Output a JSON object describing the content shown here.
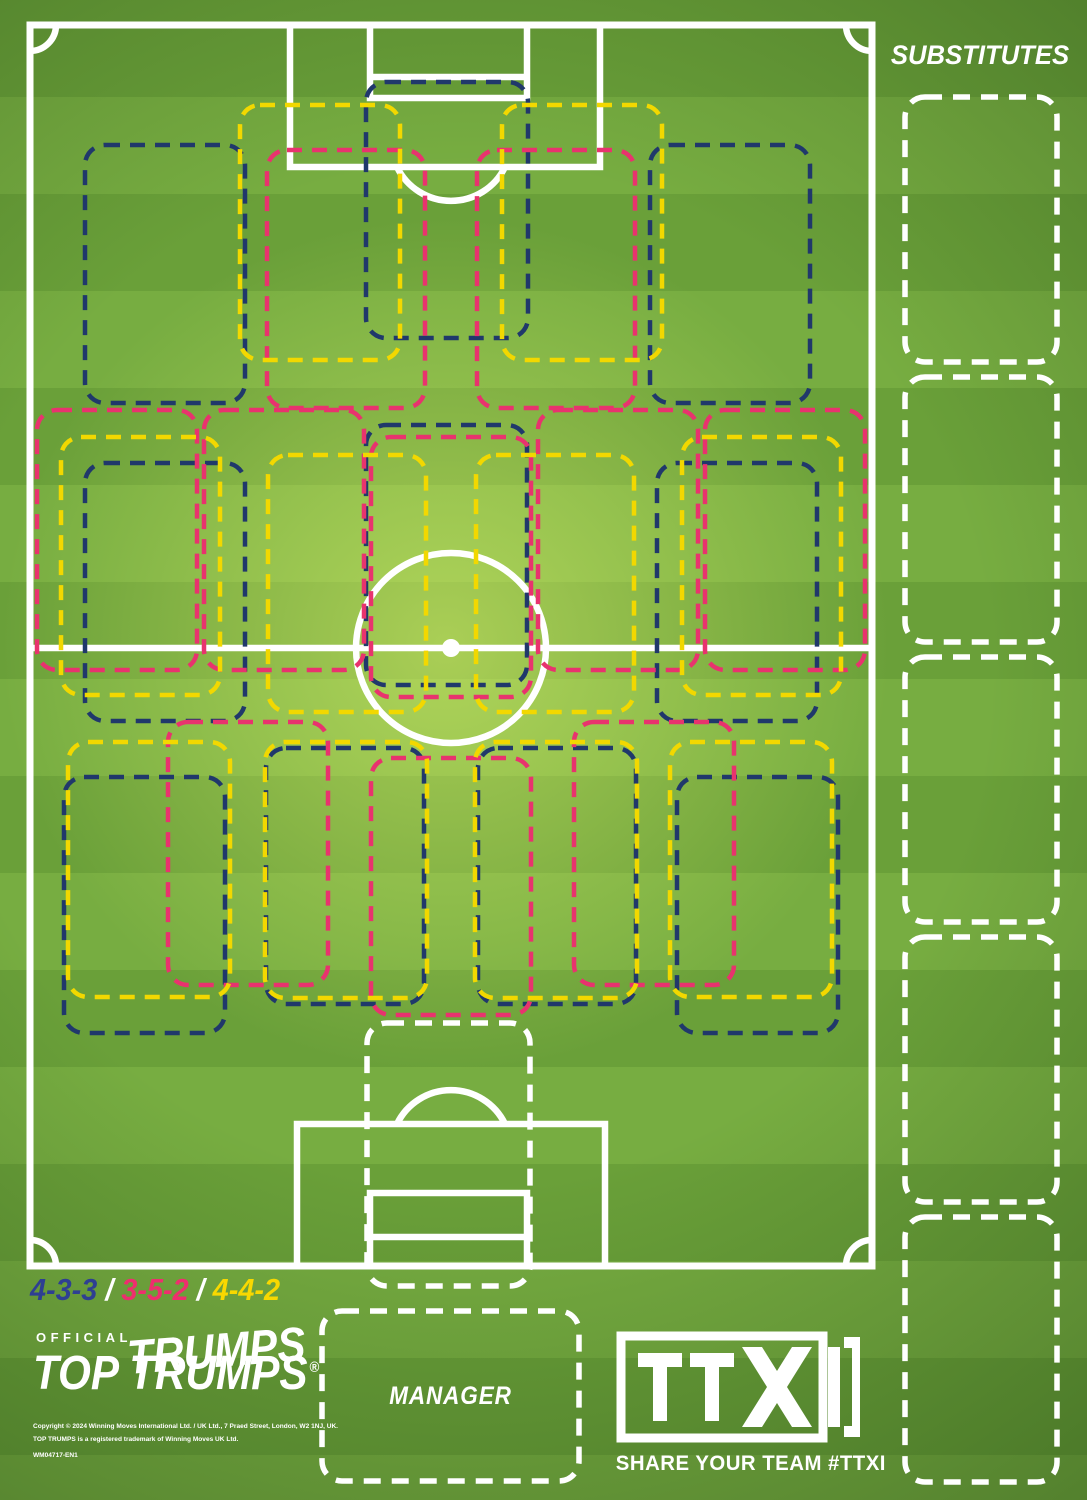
{
  "colors": {
    "field_dark": "#6aa039",
    "field_light": "#77ad41",
    "line_white": "#ffffff",
    "navy": "#20386b",
    "pink": "#e8336e",
    "yellow": "#f2d800"
  },
  "legend": {
    "separator": "/",
    "items": [
      {
        "label": "4-3-3",
        "color": "#2e3f92"
      },
      {
        "label": "3-5-2",
        "color": "#ee2e6e"
      },
      {
        "label": "4-4-2",
        "color": "#f8d800"
      }
    ]
  },
  "formations": [
    {
      "name": "4-3-3",
      "color": "#20386b",
      "slots": [
        {
          "pos": "st",
          "x": 366,
          "y": 82,
          "w": 162,
          "h": 256
        },
        {
          "pos": "lw",
          "x": 85,
          "y": 145,
          "w": 160,
          "h": 258
        },
        {
          "pos": "rw",
          "x": 650,
          "y": 145,
          "w": 160,
          "h": 258
        },
        {
          "pos": "lcm",
          "x": 85,
          "y": 463,
          "w": 160,
          "h": 258
        },
        {
          "pos": "cm",
          "x": 366,
          "y": 425,
          "w": 161,
          "h": 260
        },
        {
          "pos": "rcm",
          "x": 657,
          "y": 463,
          "w": 160,
          "h": 258
        },
        {
          "pos": "lb",
          "x": 64,
          "y": 777,
          "w": 161,
          "h": 256
        },
        {
          "pos": "lcb",
          "x": 266,
          "y": 748,
          "w": 158,
          "h": 256
        },
        {
          "pos": "rcb",
          "x": 478,
          "y": 748,
          "w": 158,
          "h": 256
        },
        {
          "pos": "rb",
          "x": 677,
          "y": 777,
          "w": 161,
          "h": 256
        }
      ]
    },
    {
      "name": "3-5-2",
      "color": "#e8336e",
      "slots": [
        {
          "pos": "st-left",
          "x": 267,
          "y": 150,
          "w": 158,
          "h": 258
        },
        {
          "pos": "st-right",
          "x": 477,
          "y": 150,
          "w": 158,
          "h": 258
        },
        {
          "pos": "lm",
          "x": 37,
          "y": 410,
          "w": 160,
          "h": 260
        },
        {
          "pos": "lcm",
          "x": 204,
          "y": 410,
          "w": 160,
          "h": 260
        },
        {
          "pos": "cm",
          "x": 371,
          "y": 437,
          "w": 160,
          "h": 260
        },
        {
          "pos": "rcm",
          "x": 538,
          "y": 410,
          "w": 160,
          "h": 260
        },
        {
          "pos": "rm",
          "x": 705,
          "y": 410,
          "w": 160,
          "h": 260
        },
        {
          "pos": "cb-left",
          "x": 168,
          "y": 722,
          "w": 160,
          "h": 263
        },
        {
          "pos": "cb-center",
          "x": 371,
          "y": 758,
          "w": 160,
          "h": 257
        },
        {
          "pos": "cb-right",
          "x": 574,
          "y": 722,
          "w": 160,
          "h": 263
        }
      ]
    },
    {
      "name": "4-4-2",
      "color": "#f2d800",
      "slots": [
        {
          "pos": "st-left",
          "x": 240,
          "y": 105,
          "w": 160,
          "h": 255
        },
        {
          "pos": "st-right",
          "x": 502,
          "y": 105,
          "w": 160,
          "h": 255
        },
        {
          "pos": "lm",
          "x": 61,
          "y": 437,
          "w": 159,
          "h": 258
        },
        {
          "pos": "lcm",
          "x": 268,
          "y": 455,
          "w": 158,
          "h": 257
        },
        {
          "pos": "rcm",
          "x": 476,
          "y": 455,
          "w": 158,
          "h": 257
        },
        {
          "pos": "rm",
          "x": 682,
          "y": 437,
          "w": 159,
          "h": 258
        },
        {
          "pos": "lb",
          "x": 68,
          "y": 742,
          "w": 162,
          "h": 255
        },
        {
          "pos": "lcb",
          "x": 265,
          "y": 742,
          "w": 162,
          "h": 256
        },
        {
          "pos": "rcb",
          "x": 475,
          "y": 742,
          "w": 162,
          "h": 256
        },
        {
          "pos": "rb",
          "x": 670,
          "y": 742,
          "w": 162,
          "h": 255
        }
      ]
    }
  ],
  "goalkeeper_slot": {
    "color": "#ffffff",
    "x": 367,
    "y": 1023,
    "w": 163,
    "h": 263
  },
  "substitutes": {
    "title": "SUBSTITUTES",
    "color": "#ffffff",
    "slots": [
      {
        "x": 905,
        "y": 97,
        "w": 152,
        "h": 265
      },
      {
        "x": 905,
        "y": 377,
        "w": 152,
        "h": 265
      },
      {
        "x": 905,
        "y": 657,
        "w": 152,
        "h": 265
      },
      {
        "x": 905,
        "y": 937,
        "w": 152,
        "h": 265
      },
      {
        "x": 905,
        "y": 1217,
        "w": 152,
        "h": 265
      }
    ]
  },
  "manager": {
    "label": "MANAGER",
    "color": "#ffffff",
    "x": 322,
    "y": 1311,
    "w": 257,
    "h": 170
  },
  "branding": {
    "official": "OFFICIAL",
    "logo": "TOP TRUMPS",
    "logo_echo": "TRUMPS",
    "registered": "®",
    "copyright_line1": "Copyright © 2024 Winning Moves International Ltd. / UK Ltd., 7 Praed Street, London, W2 1NJ, UK.",
    "copyright_line2": "TOP TRUMPS is a registered trademark of Winning Moves UK Ltd.",
    "product_code": "WM04717-EN1"
  },
  "ttxi": {
    "logo_text": "TTXI",
    "tagline": "SHARE YOUR TEAM #TTXI"
  }
}
